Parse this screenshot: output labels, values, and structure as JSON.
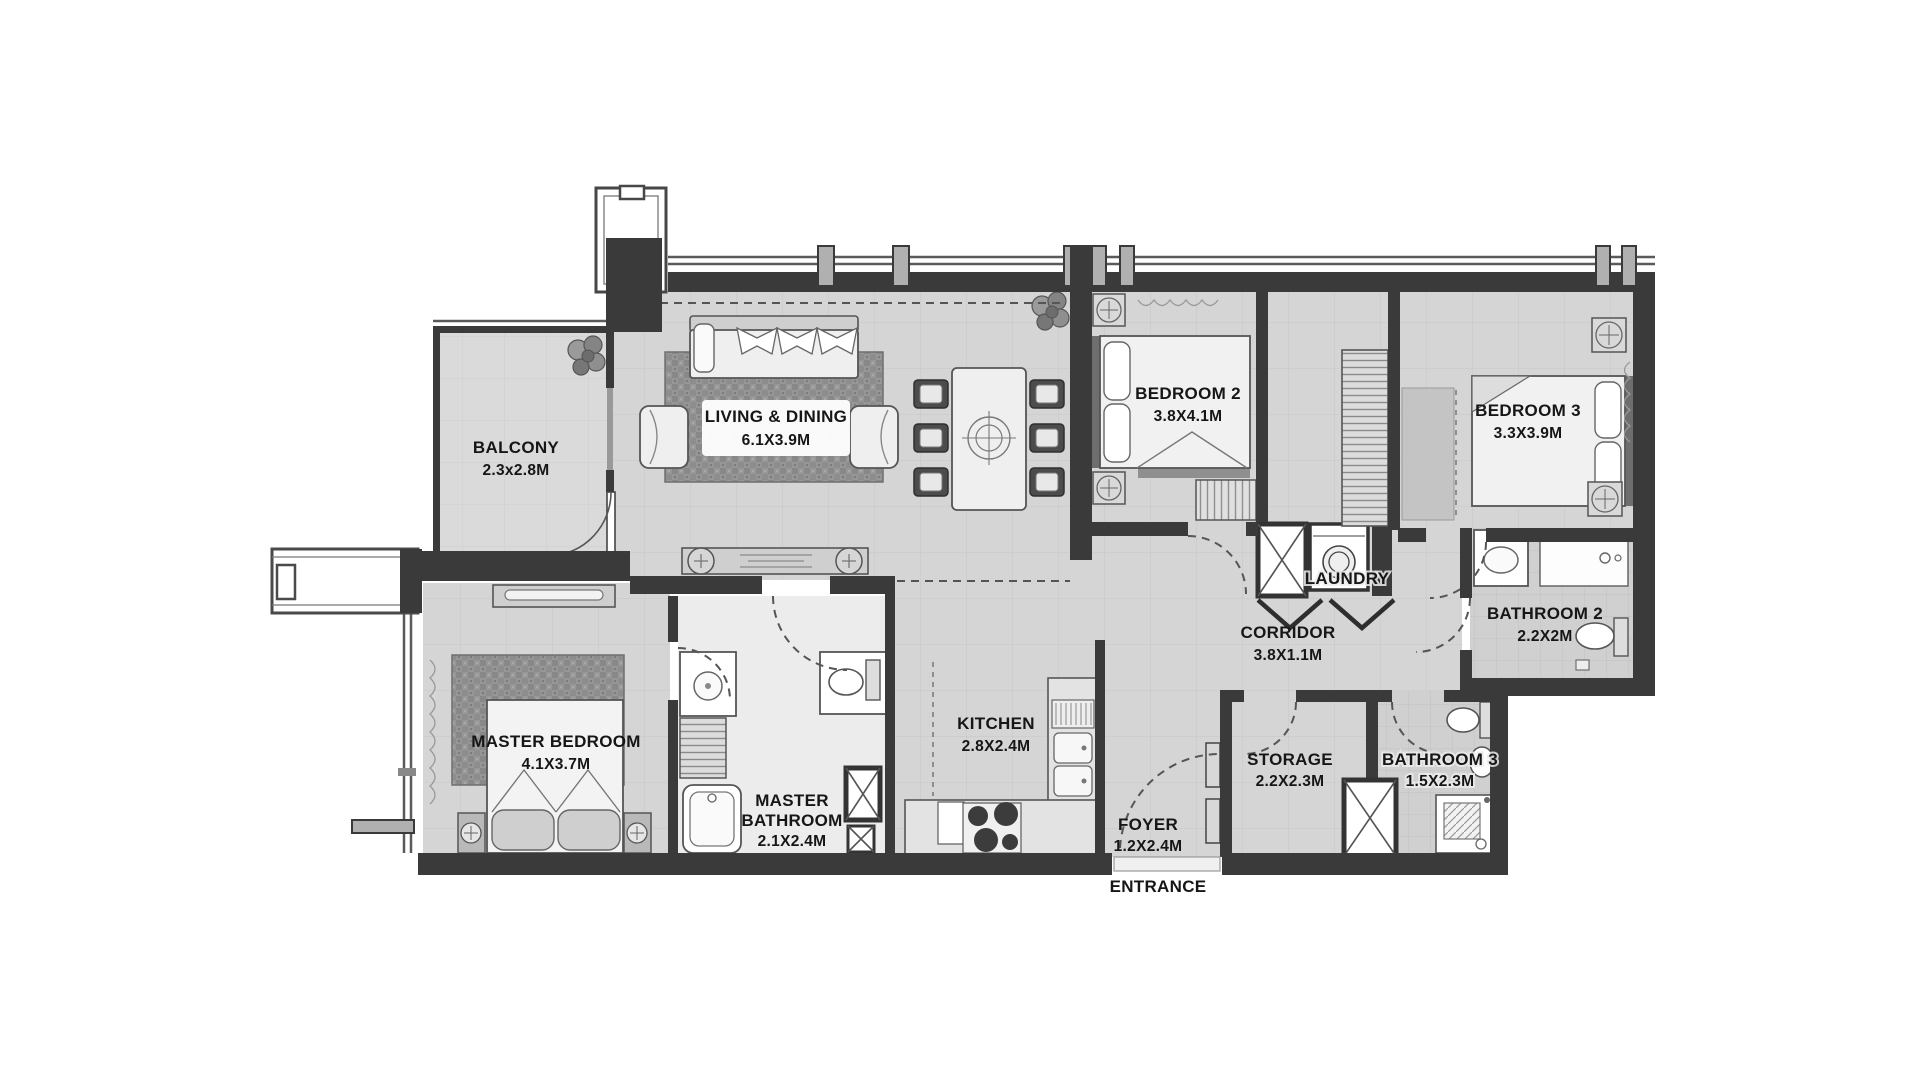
{
  "plan_type": "apartment-floor-plan",
  "colors": {
    "background": "#ffffff",
    "wall": "#3a3a3a",
    "floor": "#d5d5d5",
    "floor_balcony": "#dadada",
    "floor_bath": "#d0d0d0",
    "rug": "#8f8f8f",
    "furniture_fill": "#efefef",
    "label_text": "#161616"
  },
  "rooms": {
    "balcony": {
      "label": "BALCONY",
      "dims": "2.3x2.8M"
    },
    "living_dining": {
      "label": "LIVING & DINING",
      "dims": "6.1X3.9M"
    },
    "bedroom2": {
      "label": "BEDROOM 2",
      "dims": "3.8X4.1M"
    },
    "bedroom3": {
      "label": "BEDROOM 3",
      "dims": "3.3X3.9M"
    },
    "laundry": {
      "label": "LAUNDRY"
    },
    "corridor": {
      "label": "CORRIDOR",
      "dims": "3.8X1.1M"
    },
    "bathroom2": {
      "label": "BATHROOM 2",
      "dims": "2.2X2M"
    },
    "master_bedroom": {
      "label": "MASTER BEDROOM",
      "dims": "4.1X3.7M"
    },
    "master_bathroom": {
      "lines": [
        "MASTER",
        "BATHROOM",
        "2.1X2.4M"
      ]
    },
    "kitchen": {
      "label": "KITCHEN",
      "dims": "2.8X2.4M"
    },
    "foyer": {
      "label": "FOYER",
      "dims": "1.2X2.4M"
    },
    "storage": {
      "label": "STORAGE",
      "dims": "2.2X2.3M"
    },
    "bathroom3": {
      "label": "BATHROOM 3",
      "dims": "1.5X2.3M"
    }
  },
  "entrance": {
    "label": "ENTRANCE"
  }
}
